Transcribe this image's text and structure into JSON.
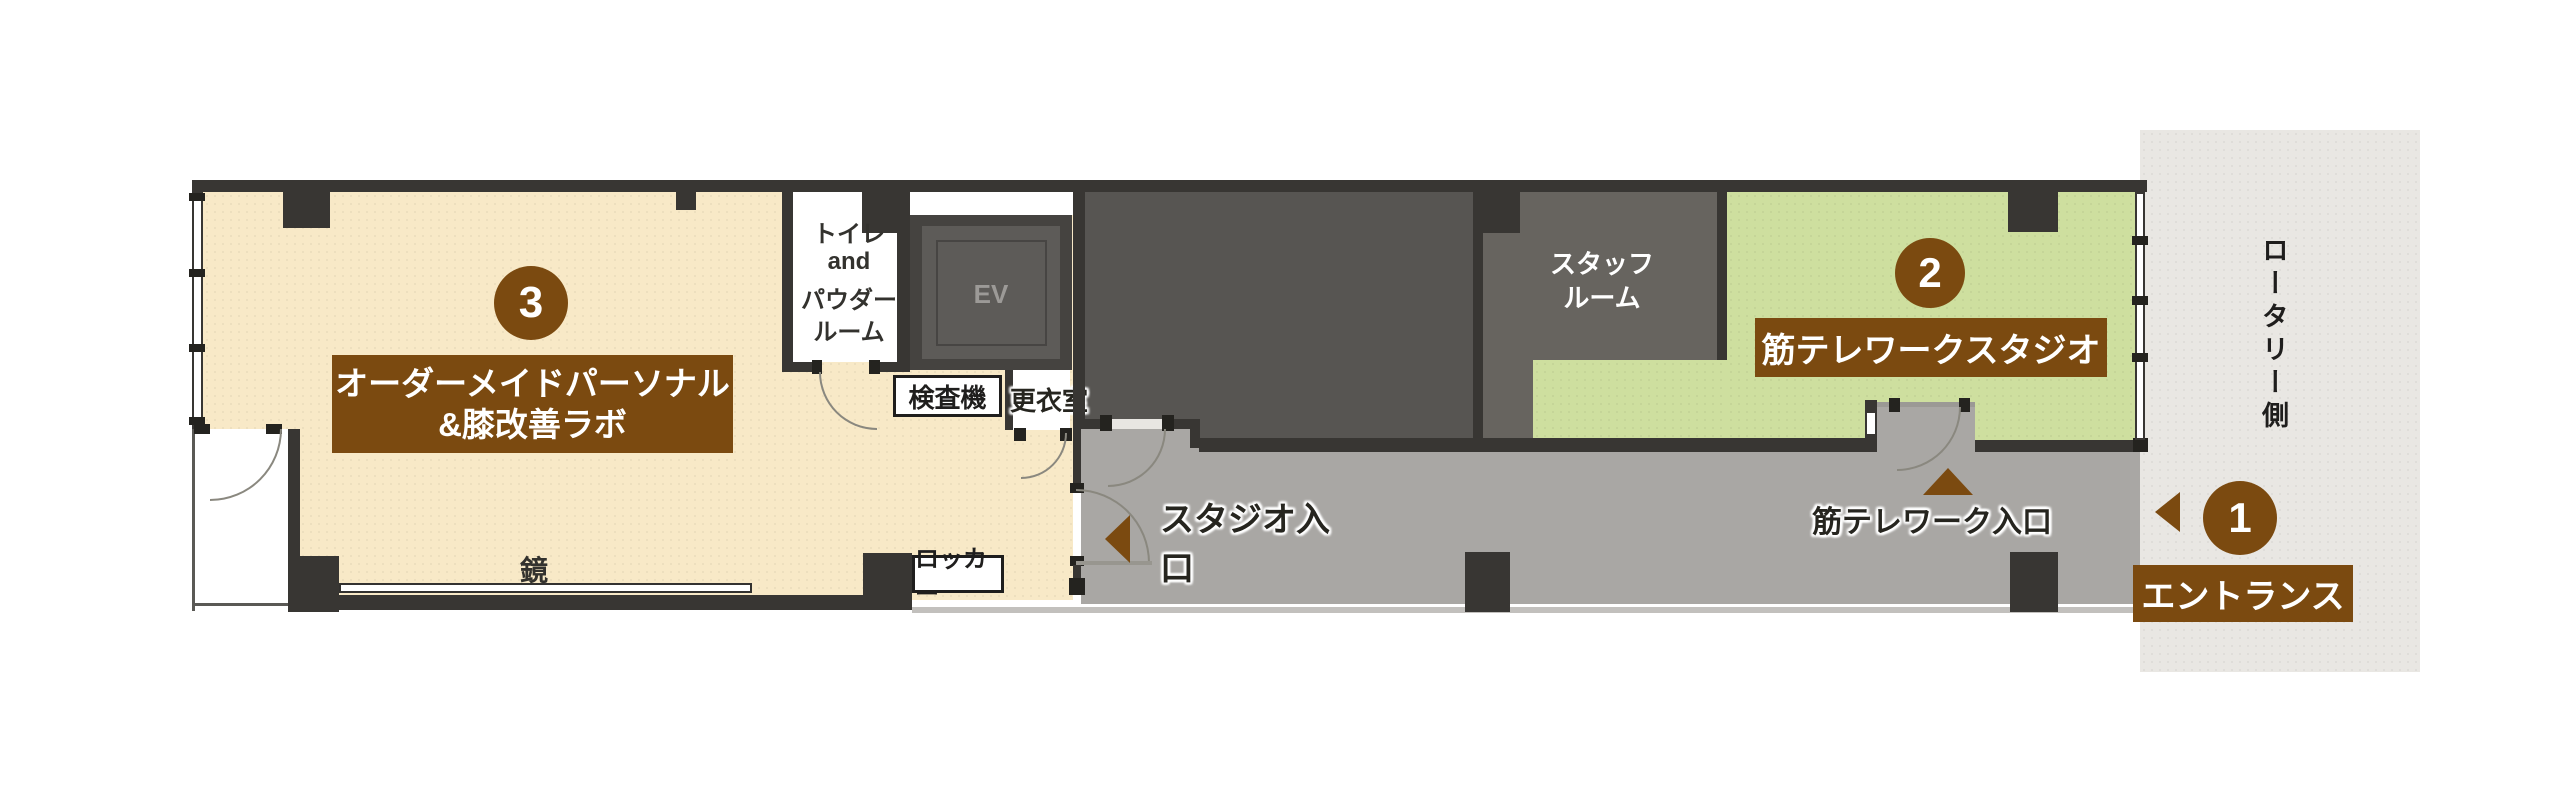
{
  "floorplan": {
    "rooms": {
      "room3": {
        "number": "3",
        "name_line1": "オーダーメイドパーソナル",
        "name_line2": "&膝改善ラボ"
      },
      "room2": {
        "number": "2",
        "name": "筋テレワークスタジオ"
      },
      "entrance": {
        "number": "1",
        "name": "エントランス"
      },
      "toilet": {
        "line1": "トイレ",
        "line2": "and",
        "line3": "パウダー",
        "line4": "ルーム"
      },
      "staff": {
        "line1": "スタッフ",
        "line2": "ルーム"
      },
      "elevator": "EV"
    },
    "labels": {
      "mirror": "鏡",
      "locker": "ロッカー",
      "inspection": "検査機",
      "changing": "更衣室",
      "studio_entrance": "スタジオ入口",
      "kin_telework_entrance": "筋テレワーク入口",
      "rotary_side": "ロータリー側"
    },
    "colors": {
      "accent_brown": "#7b4a10",
      "room3_cream": "#f8e9c7",
      "room2_green": "#cedf9f",
      "corridor_gray": "#a9a7a4",
      "studio_dark": "#575552",
      "staff_gray": "#67645f",
      "wall_dark": "#383633",
      "rotary_strip": "#e9e7e3"
    }
  }
}
